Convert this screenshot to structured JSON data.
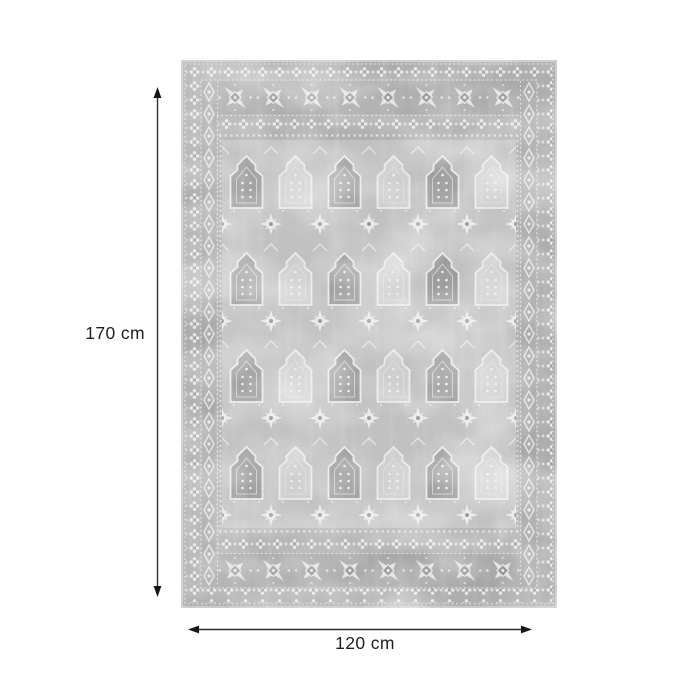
{
  "diagram": {
    "alt": "grey vintage-pattern rectangular rug, top view, with dimension arrows"
  },
  "dimensions": {
    "height_label": "170 cm",
    "width_label": "120 cm",
    "height_cm": 170,
    "width_cm": 120
  },
  "icons": {
    "height_arrow": "vertical-double-headed-arrow",
    "width_arrow": "horizontal-double-headed-arrow"
  },
  "colors": {
    "background": "#ffffff",
    "arrow": "#303030",
    "arrowhead": "#161616",
    "label_text": "#1f1f1f",
    "rug_binding": "#cdcdcd",
    "rug_base": "#b0b0b0",
    "rug_band": "#a6a6a6",
    "rug_field": "#c3c3c3",
    "rug_motif_light": "#eeefee",
    "rug_motif_dark": "#9b9b9b"
  }
}
